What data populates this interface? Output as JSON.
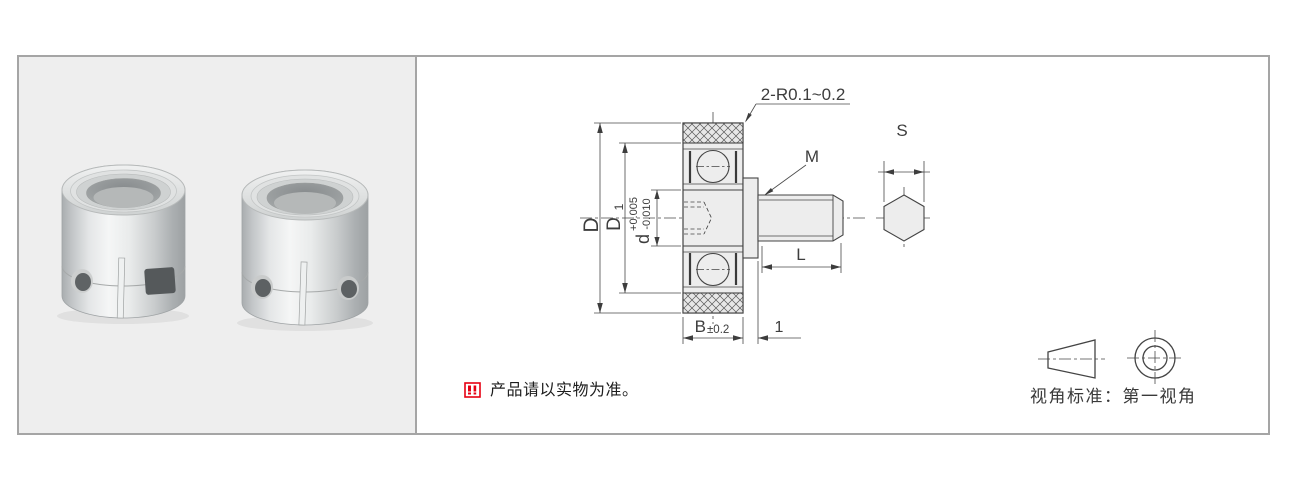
{
  "drawing": {
    "corner_note": "2-R0.1~0.2",
    "thread_label": "M",
    "hex_width_label": "S",
    "outer_diameter_label": "D",
    "race_diameter_main": "D",
    "race_diameter_sub": "1",
    "bore_diameter_label": "d",
    "bore_tolerance_plus": "+0.005",
    "bore_tolerance_minus": "-0.010",
    "stud_length_label": "L",
    "ring_width_label": "B",
    "ring_width_tolerance": "±0.2",
    "step_width_label": "1"
  },
  "footer": {
    "disclaimer": "产品请以实物为准。",
    "projection_caption": "视角标准：第一视角"
  },
  "colors": {
    "dimension_red": "#e60012",
    "line_dark": "#444444",
    "panel_gray": "#eeeeee"
  }
}
